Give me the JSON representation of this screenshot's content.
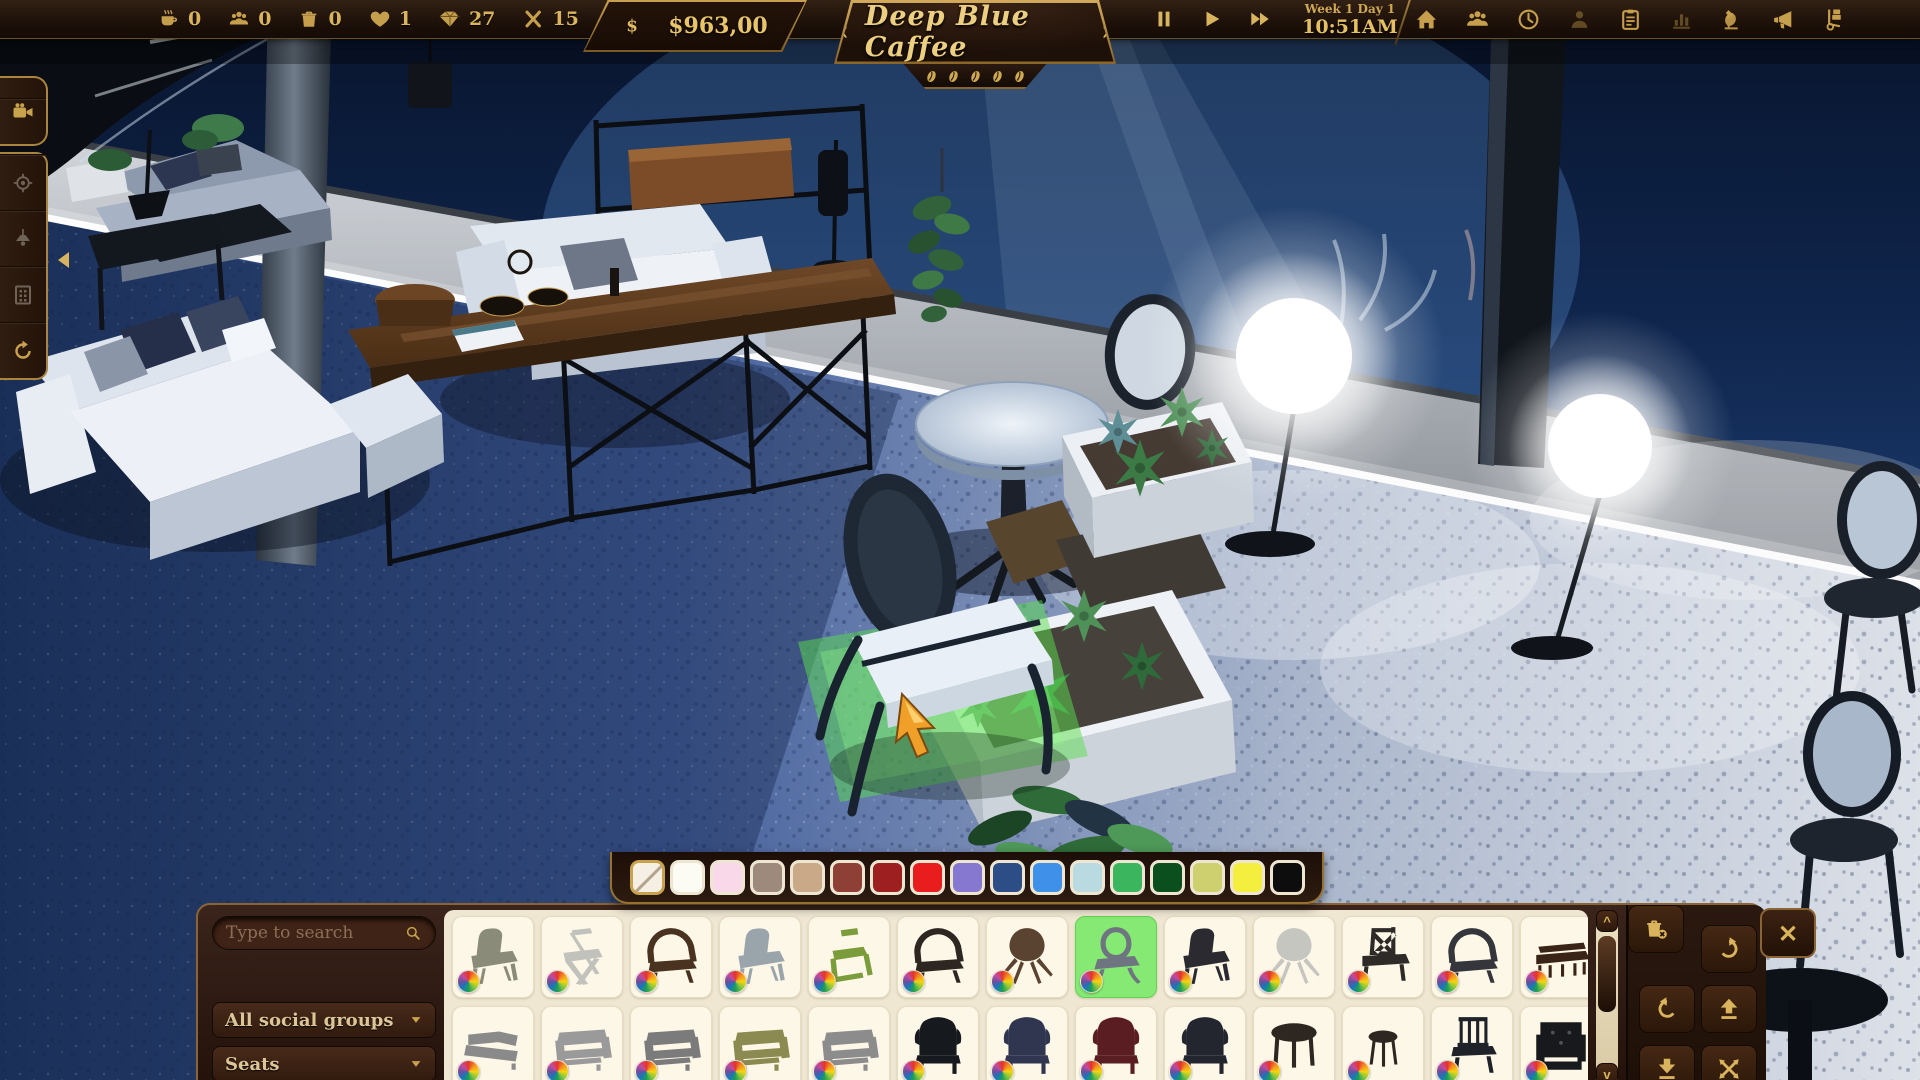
{
  "top_bar": {
    "stats": [
      {
        "icon": "coffee-cup",
        "name": "coffees",
        "value": "0"
      },
      {
        "icon": "customer-group",
        "name": "customers",
        "value": "0"
      },
      {
        "icon": "trash-bin",
        "name": "trash",
        "value": "0"
      },
      {
        "icon": "heart",
        "name": "likes",
        "value": "1"
      },
      {
        "icon": "diamond",
        "name": "diamonds",
        "value": "27"
      },
      {
        "icon": "x-count",
        "name": "multiplier",
        "value": "15"
      }
    ],
    "money": {
      "icon": "dollar",
      "amount": "$963,00"
    },
    "cafe": {
      "prev": "‹",
      "name": "Deep Blue Caffee",
      "next": "›",
      "rating_beans": 5
    },
    "time": {
      "controls": [
        {
          "icon": "pause",
          "name": "pause"
        },
        {
          "icon": "play",
          "name": "play"
        },
        {
          "icon": "fast-forward",
          "name": "fast-forward"
        }
      ],
      "date": "Week 1 Day 1",
      "clock": "10:51AM"
    },
    "menu": [
      {
        "icon": "home"
      },
      {
        "icon": "staff"
      },
      {
        "icon": "clock-menu"
      },
      {
        "icon": "customer",
        "dim": true
      },
      {
        "icon": "tasks"
      },
      {
        "icon": "statistics",
        "dim": true
      },
      {
        "icon": "research"
      },
      {
        "icon": "marketing"
      },
      {
        "icon": "delivery"
      }
    ]
  },
  "left_toolbar": {
    "primary": [
      {
        "icon": "camera",
        "active": true
      }
    ],
    "secondary": [
      {
        "icon": "focus"
      },
      {
        "icon": "ceiling-lamp"
      },
      {
        "icon": "walls"
      },
      {
        "icon": "rotate-camera",
        "active": true
      }
    ]
  },
  "palette": {
    "swatches": [
      {
        "color": "#f6f0e4",
        "none": true,
        "selected": true
      },
      {
        "color": "#fdfcf4"
      },
      {
        "color": "#f9d9e9"
      },
      {
        "color": "#9d8a7d"
      },
      {
        "color": "#c9a987"
      },
      {
        "color": "#8e4036"
      },
      {
        "color": "#9d1f1f"
      },
      {
        "color": "#e91d1d"
      },
      {
        "color": "#8678d0"
      },
      {
        "color": "#2d4d87"
      },
      {
        "color": "#3f90e9"
      },
      {
        "color": "#b8dae0"
      },
      {
        "color": "#3cb55f"
      },
      {
        "color": "#0c4f1e"
      },
      {
        "color": "#ced06f"
      },
      {
        "color": "#f4ef3e"
      },
      {
        "color": "#0d0d0d"
      }
    ]
  },
  "build_panel": {
    "search": {
      "placeholder": "Type to search"
    },
    "filters": [
      {
        "label": "All social groups"
      },
      {
        "label": "Seats"
      }
    ],
    "rows": [
      {
        "items": [
          {
            "name": "side-chair-olive",
            "kind": "side-chair",
            "color": "#8b8b7a"
          },
          {
            "name": "folding-chair-white",
            "kind": "folding-chair",
            "color": "#c2c2bc"
          },
          {
            "name": "captain-armchair-wood",
            "kind": "armchair-round",
            "color": "#4a3220"
          },
          {
            "name": "side-chair-gray",
            "kind": "side-chair",
            "color": "#9aa4ab"
          },
          {
            "name": "stacking-chair-green",
            "kind": "stack-chair",
            "color": "#7b9c3a"
          },
          {
            "name": "round-back-chair-dark",
            "kind": "armchair-round",
            "color": "#2e2721"
          },
          {
            "name": "shell-chair-brown",
            "kind": "shell-chair",
            "color": "#5a4330"
          },
          {
            "name": "medallion-chair-gray",
            "kind": "medallion-chair",
            "color": "#6f7580",
            "selected": true
          },
          {
            "name": "bistro-chair-black",
            "kind": "side-chair",
            "color": "#2a2a30"
          },
          {
            "name": "shell-chair-white",
            "kind": "shell-chair",
            "color": "#c6c6c0"
          },
          {
            "name": "cross-back-chair-black",
            "kind": "x-back-chair",
            "color": "#2e2a28"
          },
          {
            "name": "mesh-armchair-black",
            "kind": "armchair-round",
            "color": "#35353c"
          },
          {
            "name": "bench-dark-wood",
            "kind": "bench",
            "color": "#3a2418"
          }
        ]
      },
      {
        "items": [
          {
            "name": "corner-sofa-gray",
            "kind": "corner-sofa",
            "color": "#8a8a8a"
          },
          {
            "name": "sofa-light-gray",
            "kind": "sofa",
            "color": "#9a9a9a"
          },
          {
            "name": "sofa-gray",
            "kind": "sofa",
            "color": "#7b7b7b"
          },
          {
            "name": "sofa-olive",
            "kind": "sofa",
            "color": "#8b8b51"
          },
          {
            "name": "sofa-gray-2",
            "kind": "sofa",
            "color": "#8c8c8c"
          },
          {
            "name": "wingback-chair-black",
            "kind": "wingback",
            "color": "#16191d"
          },
          {
            "name": "wingback-chair-pattern",
            "kind": "wingback",
            "color": "#30364f"
          },
          {
            "name": "wingback-chair-red",
            "kind": "wingback",
            "color": "#5a1d21"
          },
          {
            "name": "wingback-chair-dark",
            "kind": "wingback",
            "color": "#23262e"
          },
          {
            "name": "round-table-dark",
            "kind": "round-table",
            "color": "#2e2721"
          },
          {
            "name": "side-table-dark",
            "kind": "side-table",
            "color": "#2e2721"
          },
          {
            "name": "slat-chair-black",
            "kind": "slat-chair",
            "color": "#1f2329"
          },
          {
            "name": "tufted-armchair-black",
            "kind": "tufted-chair",
            "color": "#17191d"
          }
        ]
      }
    ],
    "scroll": {
      "up": "^",
      "down": "v"
    },
    "actions": [
      {
        "icon": "rot-cw",
        "name": "rotate-right"
      },
      {
        "icon": "rot-ccw",
        "name": "rotate-left"
      },
      {
        "icon": "raise",
        "name": "raise"
      },
      {
        "icon": "lower",
        "name": "lower"
      },
      {
        "icon": "move-cross",
        "name": "move"
      },
      {
        "icon": "delete-item",
        "name": "delete"
      }
    ],
    "close_label": "✕"
  }
}
